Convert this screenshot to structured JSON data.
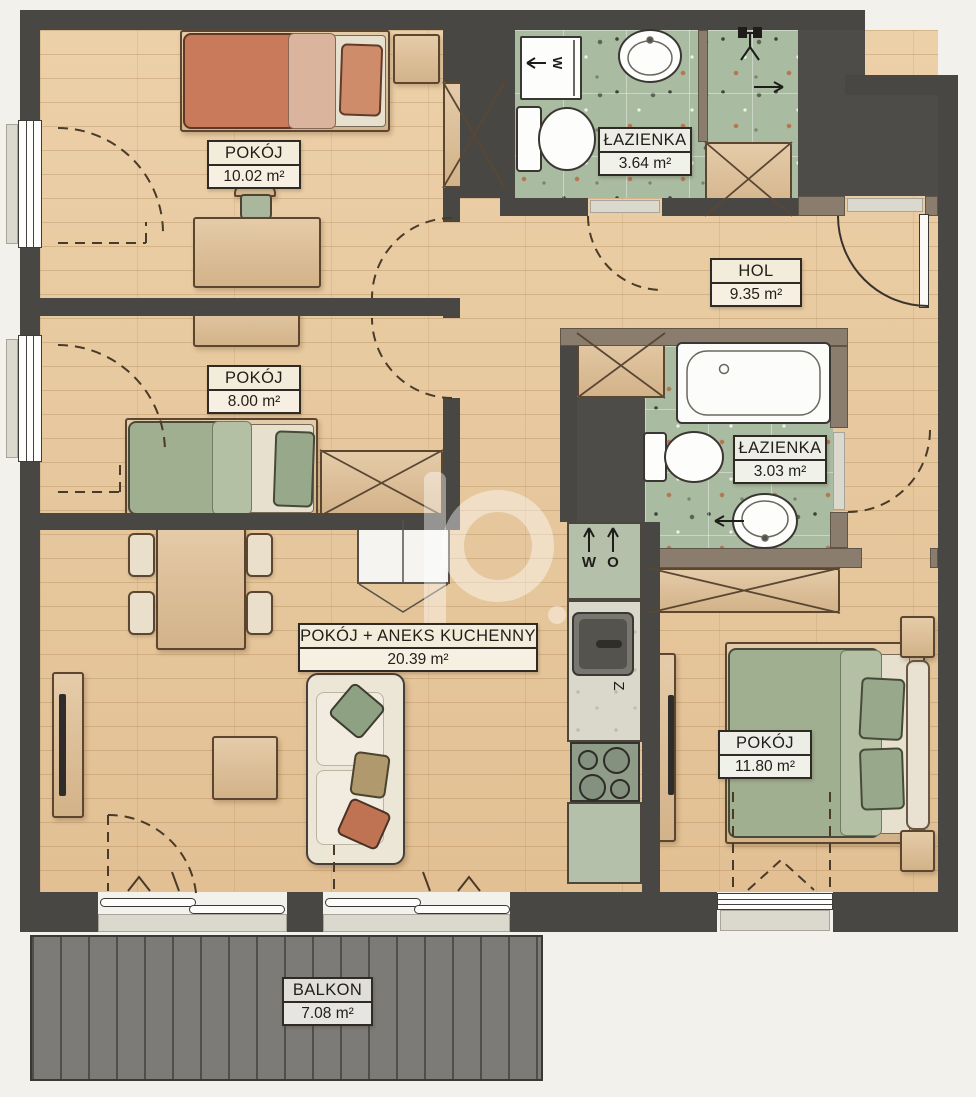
{
  "rooms": [
    {
      "name": "POKÓJ",
      "area": "10.02 m²"
    },
    {
      "name": "ŁAZIENKA",
      "area": "3.64 m²"
    },
    {
      "name": "HOL",
      "area": "9.35 m²"
    },
    {
      "name": "POKÓJ",
      "area": "8.00 m²"
    },
    {
      "name": "ŁAZIENKA",
      "area": "3.03 m²"
    },
    {
      "name": "POKÓJ + ANEKS KUCHENNY",
      "area": "20.39 m²"
    },
    {
      "name": "POKÓJ",
      "area": "11.80 m²"
    },
    {
      "name": "BALKON",
      "area": "7.08 m²"
    }
  ],
  "annotations": {
    "washer_label": "W",
    "kitchen_water_label": "W",
    "kitchen_drain_label": "O",
    "kitchen_sink_label": "Z"
  },
  "colors": {
    "wall": "#494744",
    "interior_partition": "#8a7d6d",
    "wood_floor": "#e7c79d",
    "bathroom_floor": "#a9bba1",
    "balcony_deck": "#7c7b78",
    "terracotta_bed": "#c87a5a",
    "sage_bed": "#a0af90",
    "label_border": "#2f2b24"
  }
}
